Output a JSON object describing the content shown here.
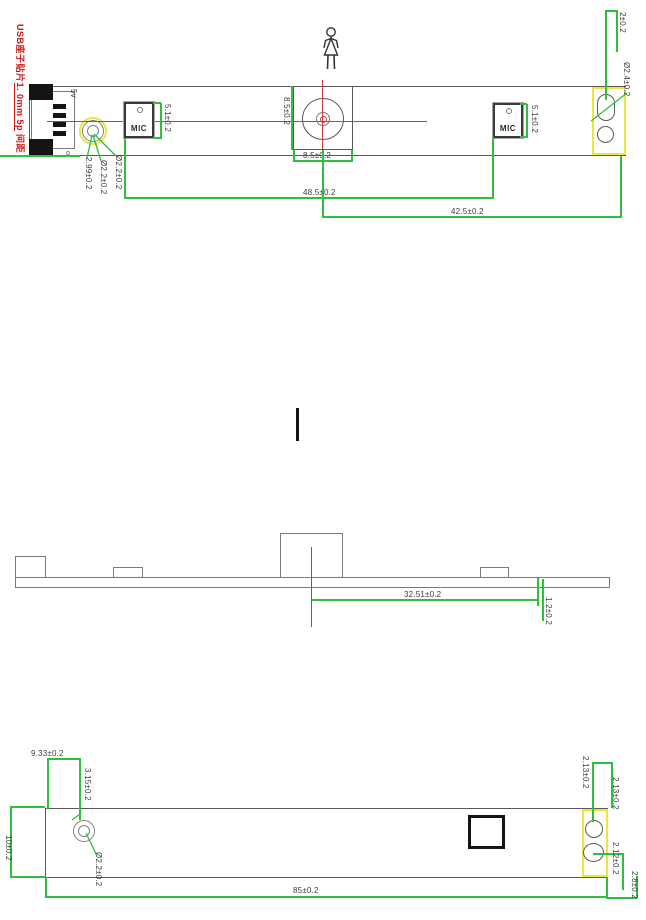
{
  "colors": {
    "dim_line": "#2fbf3f",
    "centerline": "#c43c3c",
    "highlight": "#ece73e",
    "outline": "#5a5a5a",
    "note_red": "#cc1616"
  },
  "note": {
    "part1": "USB座子贴片",
    "part2": "1. 0mm 5p",
    "part3": " 间距"
  },
  "top_view": {
    "usb_label": "5v",
    "pin_marker": "o",
    "mic_label_left": "MIC",
    "mic_label_right": "MIC",
    "dim_mic_left_height": "5.1±0.2",
    "dim_mic_right_height": "5.1±0.2",
    "dim_lens_height": "8.5±0.2",
    "dim_lens_width": "8.5±0.2",
    "dim_mic_pitch": "48.5±0.2",
    "dim_lens_to_right_edge": "42.5±0.2",
    "dim_hole_offset": "2.99±0.2",
    "dim_hole_dia_1": "Ø2.2±0.2",
    "dim_hole_dia_2": "Ø2.2±0.2",
    "dim_right_hole_to_edge": "2±0.2",
    "dim_right_hole_dia": "Ø2.4±0.2"
  },
  "side_view": {
    "dim_lens_offset": "32.51±0.2",
    "dim_board_thickness": "1.2±0.2"
  },
  "bottom_view": {
    "dim_hole_x": "9.33±0.2",
    "dim_hole_y": "3.15±0.2",
    "dim_board_width": "10±0.2",
    "dim_hole_dia": "Ø2.2±0.2",
    "dim_board_length": "85±0.2",
    "dim_right_hole_a": "2.13±0.2",
    "dim_right_hole_b": "2.13±0.2",
    "dim_right_hole_c": "2.12±0.2",
    "dim_right_edge": "2.8±0.2"
  }
}
